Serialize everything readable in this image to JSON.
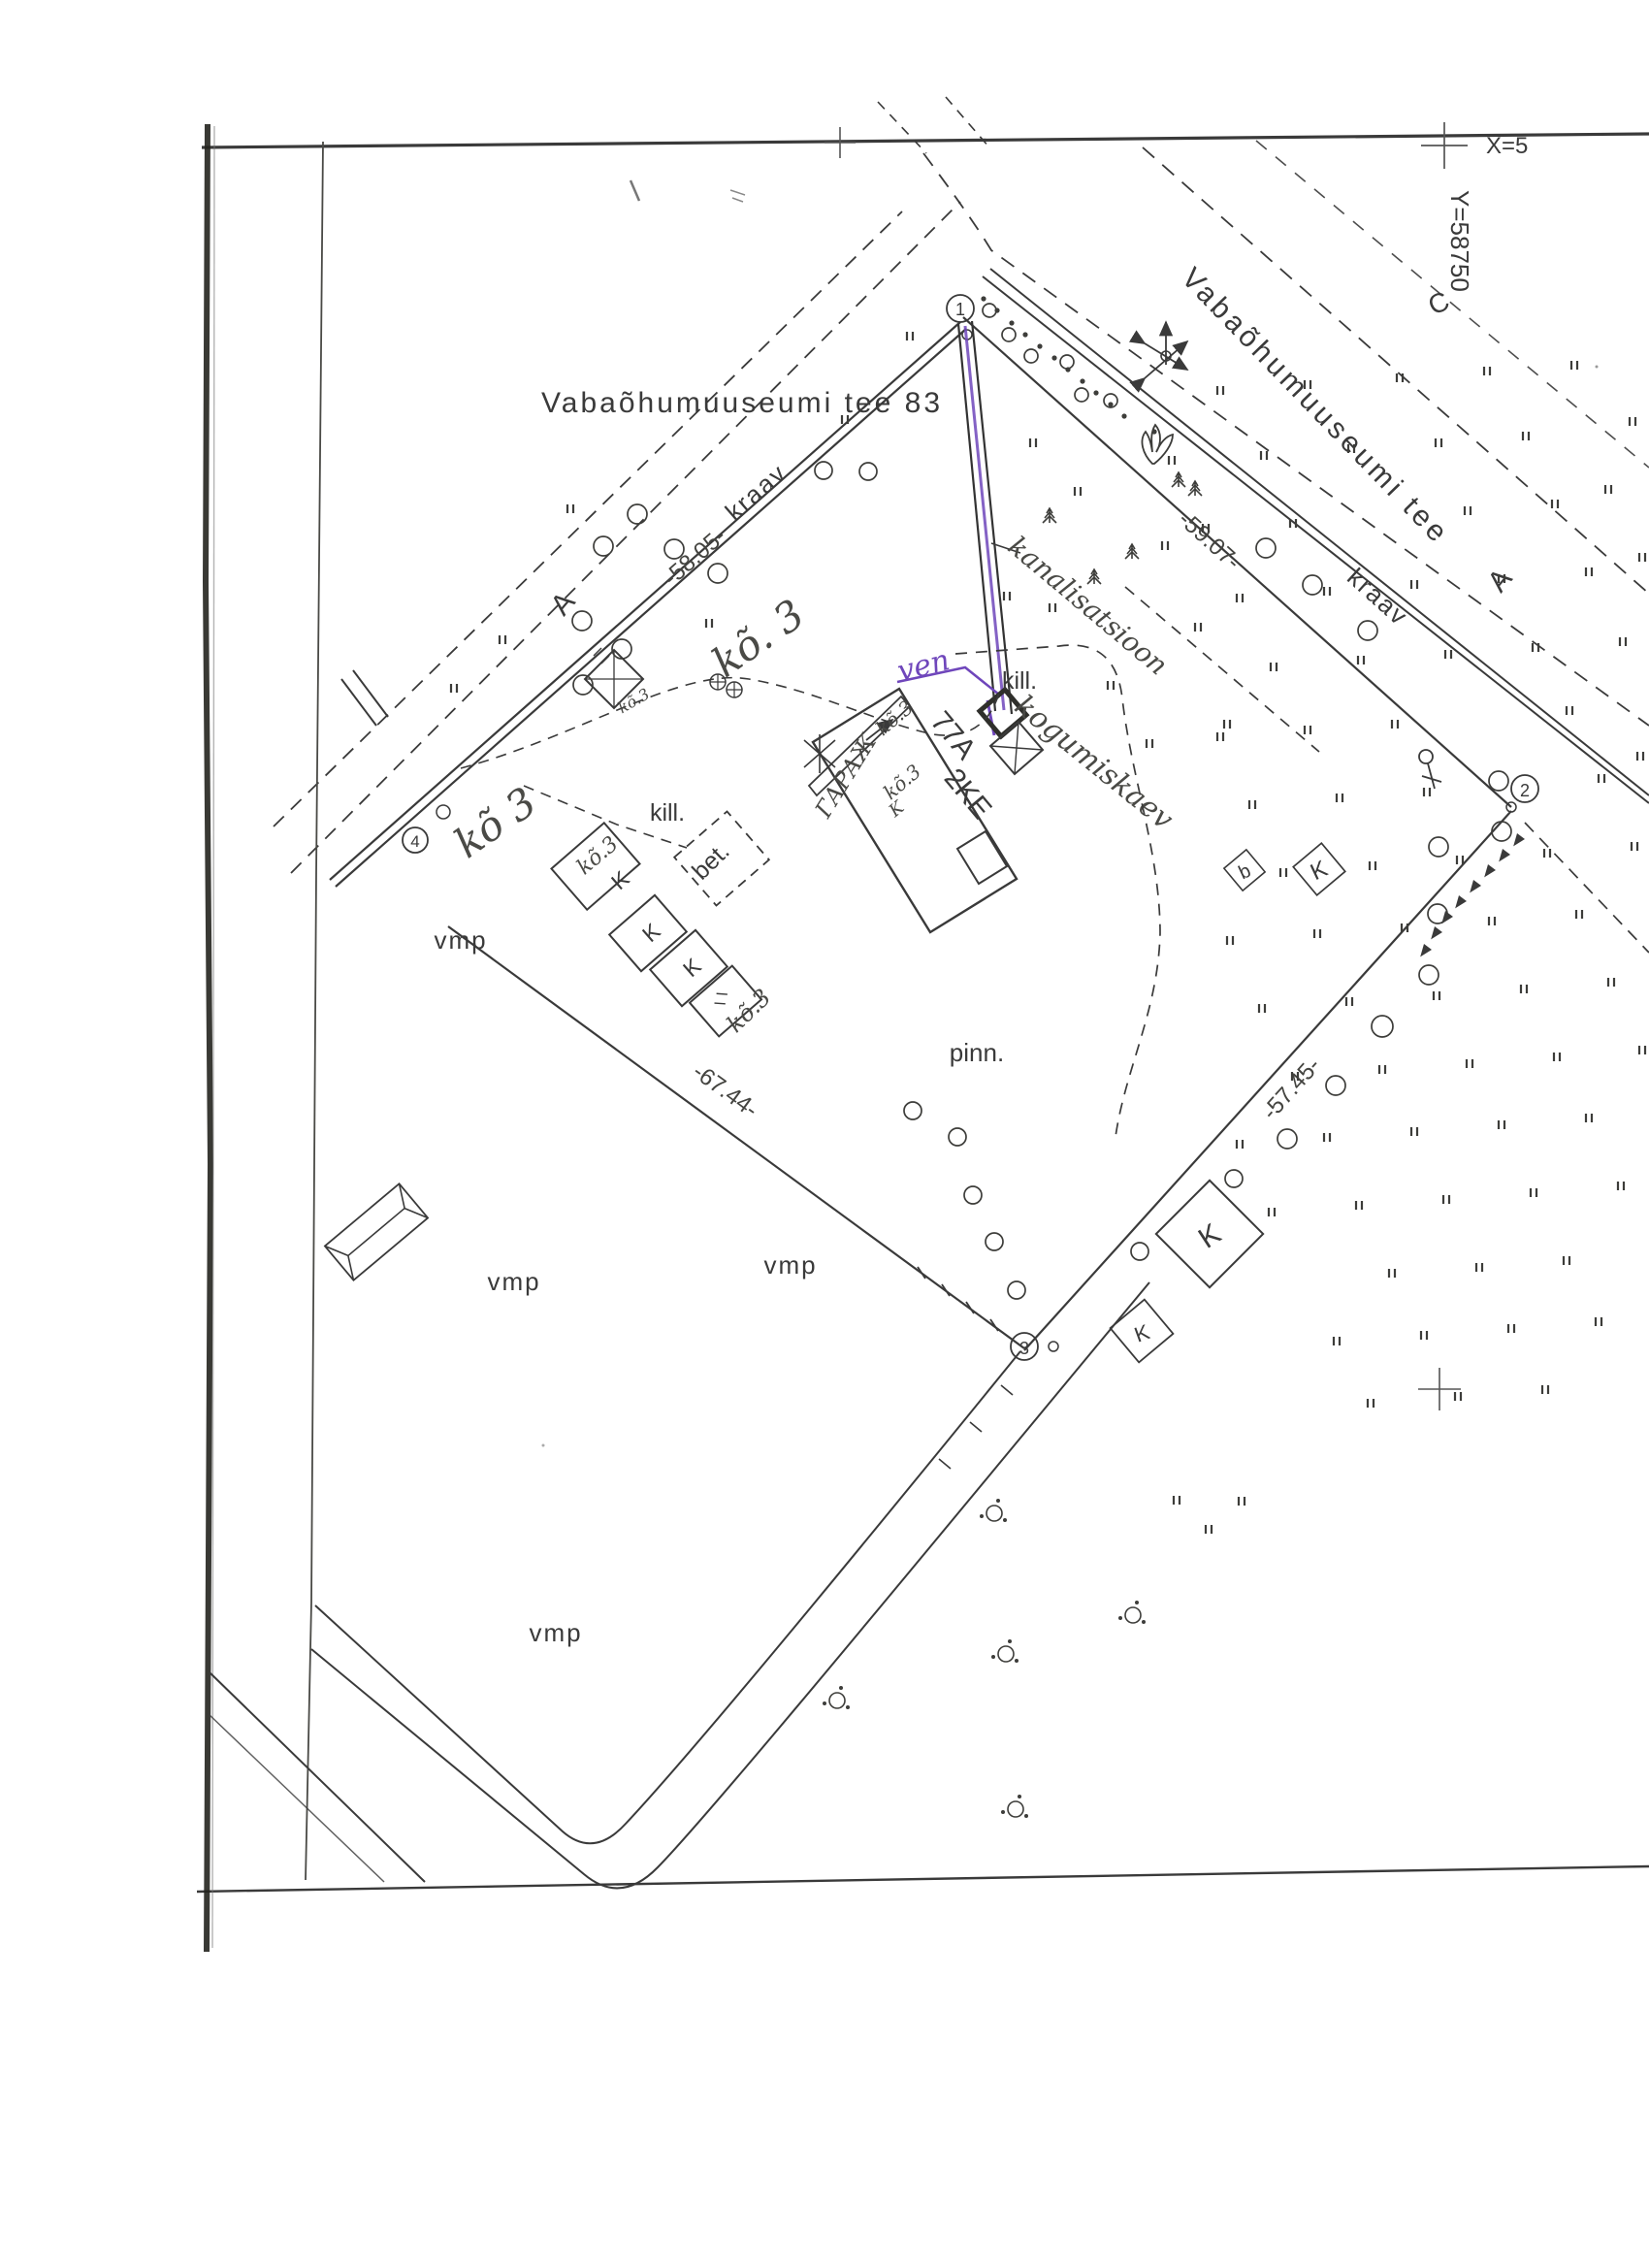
{
  "sheet": {
    "coord_x": "X=5",
    "coord_y": "Y=58750"
  },
  "labels": {
    "address": "Vabaõhumuuseumi tee 83",
    "street": "Vabaõhumuuseumi tee",
    "ditch": "kraav",
    "surface_asphalt": "vmp",
    "surface_ground": "pinn.",
    "surface_gravel": "kill.",
    "surface_concrete": "bet.",
    "house_number": "77A",
    "house_type": "2KE",
    "letter_a": "A",
    "letter_c": "C",
    "letter_k": "K",
    "letter_b": "b"
  },
  "dimensions": {
    "nw": "-58.05-",
    "ne": "-59.07-",
    "south": "-67.44-",
    "se": "-57.45-"
  },
  "corners": [
    "1",
    "2",
    "3",
    "4"
  ],
  "handwriting": {
    "water": "ven",
    "sewer": "kanalisatsioon",
    "well": "kogumiskaev",
    "garage": "ГАРАЖ",
    "note_large_nw": "kõ. 3",
    "note_large_w": "kõ 3",
    "note": "kõ.3",
    "note_k": "K"
  },
  "colors": {
    "ink": "#3a3a3a",
    "accent_purple": "#6f46bb",
    "paper": "#ffffff"
  }
}
